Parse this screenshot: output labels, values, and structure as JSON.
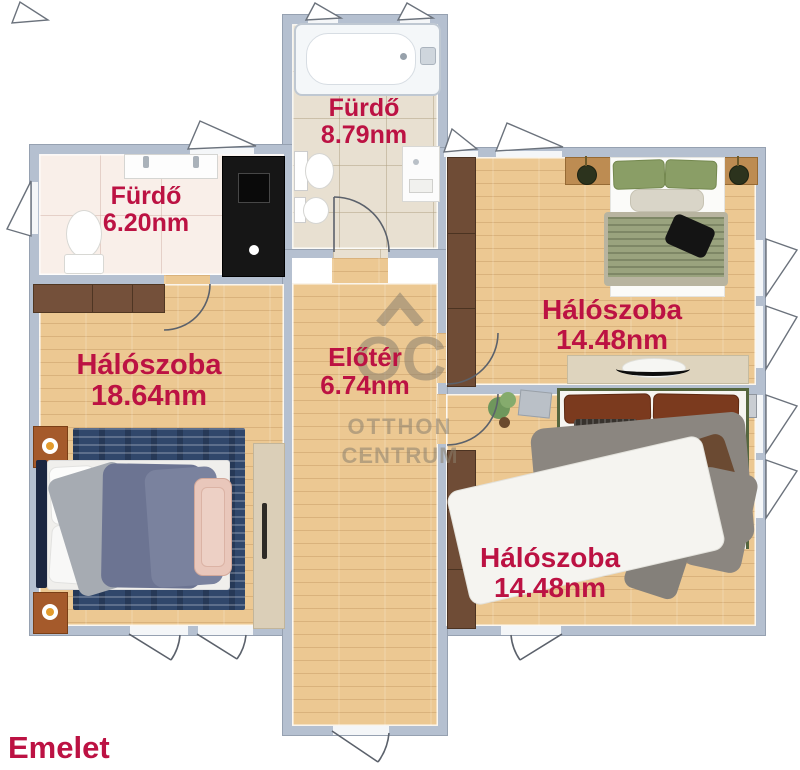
{
  "page": {
    "floor_label": "Emelet"
  },
  "watermark": {
    "initials": "OC",
    "line1": "OTTHON",
    "line2": "CENTRUM"
  },
  "rooms": {
    "furdo_top": {
      "name": "Fürdő",
      "area": "8.79nm"
    },
    "furdo_left": {
      "name": "Fürdő",
      "area": "6.20nm"
    },
    "halo_left": {
      "name": "Hálószoba",
      "area": "18.64nm"
    },
    "eloter": {
      "name": "Előtér",
      "area": "6.74nm"
    },
    "halo_top_right": {
      "name": "Hálószoba",
      "area": "14.48nm"
    },
    "halo_bottom_right": {
      "name": "Hálószoba",
      "area": "14.48nm"
    }
  },
  "colors": {
    "label_text": "#bc1243",
    "wall": "#b5c0d0",
    "wood_floor": "#ecc892",
    "tile_pink": "#f9efe9",
    "tile_beige": "#e8e0d1",
    "watermark": "#8b8070"
  }
}
